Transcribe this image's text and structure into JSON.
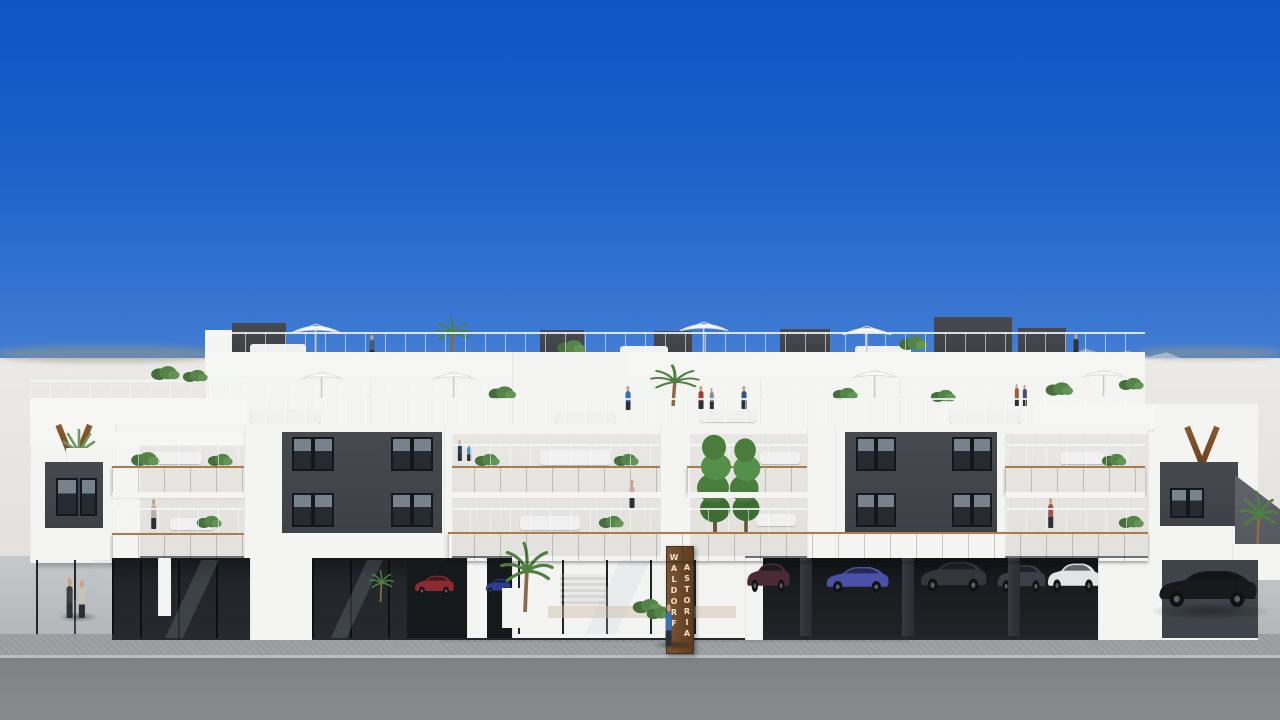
{
  "scene": {
    "type": "architectural-exterior-render",
    "description": "Photorealistic 3D rendering of a long modern three-storey apartment building with rooftop terraces, wood balcony fascias, ground-floor carport and glass lobby, under a clear blue sky",
    "sky": "clear gradient blue, hazy horizon",
    "entrance_sign": {
      "column1": "WALDORF",
      "column2": "ASTORIA",
      "material": "vertical wood plank with light lettering"
    }
  },
  "palette": {
    "sky_top": "#0f55c3",
    "sky_horizon": "#dfe7ee",
    "haze": "#e8e6e2",
    "building_white": "#f4f4f2",
    "facade_dark": "#42464a",
    "glazing": "#2c3238",
    "wood_fascia": "#7c4f2b",
    "glass_railing": "#cfd9de",
    "sidewalk": "#b6b8ba",
    "pavers": "#9da0a3",
    "road": "#85888b",
    "foliage": "#55904a"
  },
  "objects": {
    "umbrella_count": 7,
    "people_count": 14,
    "cars": [
      {
        "label": "red hatchback in carport",
        "hex": "#8c2a2e"
      },
      {
        "label": "dark blue car in carport",
        "hex": "#2b3f8c"
      },
      {
        "label": "maroon SUV in carport",
        "hex": "#4a2b33"
      },
      {
        "label": "blue-violet sedan in carport",
        "hex": "#4b51a8"
      },
      {
        "label": "dark grey SUV in carport",
        "hex": "#33363b"
      },
      {
        "label": "graphite hatchback in carport",
        "hex": "#3c4046"
      },
      {
        "label": "white SUV in carport",
        "hex": "#e2e4e6"
      },
      {
        "label": "black coupe parked on street",
        "hex": "#17191c"
      }
    ],
    "plants": "palms, bushes, tall green trees and planters on terraces and at street level"
  }
}
